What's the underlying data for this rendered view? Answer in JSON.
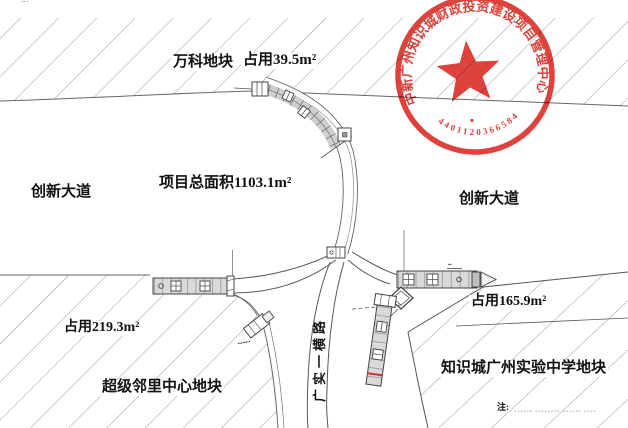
{
  "canvas": {
    "width": 628,
    "height": 428,
    "background": "#ffffff"
  },
  "labels": {
    "vanke_parcel": "万科地块",
    "vanke_occupied": "占用39.5m²",
    "innovation_ave_left": "创新大道",
    "innovation_ave_right": "创新大道",
    "project_total_area": "项目总面积1103.1m²",
    "left_occupied": "占用219.3m²",
    "neighborhood_parcel": "超级邻里中心地块",
    "right_occupied": "占用165.9m²",
    "school_parcel": "知识城广州实验中学地块",
    "vertical_road": "广实一横路",
    "note_prefix": "注:",
    "note_body_faint": "▪▪▪▪▪▪ ▪▪▪▪▪▪▪▪ ▪▪▪▪▪▪ ▪▪▪▪",
    "gate_tiny_label": "▪▪▪▪▪▪▪▪",
    "band_tiny_label": "▪▪",
    "corner_mark": "▪▪ ▪"
  },
  "seal": {
    "ring_text": "中新广州知识城财政投资建设项目管理中心",
    "serial": "4401120366584",
    "color": "#d8261e"
  },
  "style_colors": {
    "line": "#555555",
    "hatch": "#8f8f8f",
    "band_fill": "#d9d9d9",
    "seal_red": "#d8261e",
    "red_mark": "#cf3128"
  }
}
